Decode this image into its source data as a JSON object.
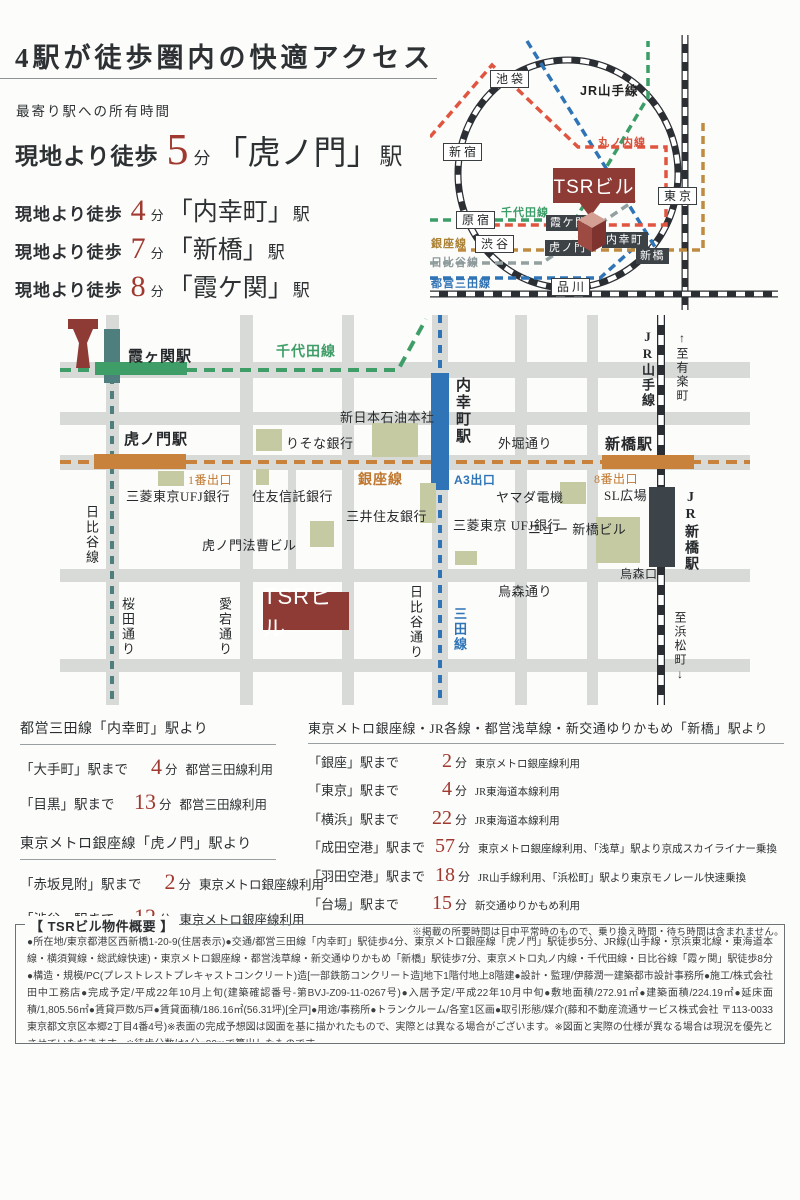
{
  "colors": {
    "accent_red": "#a03a31",
    "tsr_maroon": "#8e3b36",
    "chiyoda_green": "#3f9e68",
    "ginza_orange": "#c8823c",
    "hibiya_teal": "#4e7f7e",
    "hibiya_gray": "#93a0a0",
    "mita_blue": "#2e74b6",
    "marunouchi_red": "#e0553f",
    "building_olive": "#c6caa3",
    "road_gray": "#d8dad8"
  },
  "header": {
    "title": "4駅が徒歩圏内の快適アクセス",
    "subtitle": "最寄り駅への所有時間",
    "access": [
      {
        "prefix": "現地より徒歩",
        "num": "5",
        "unit": "分",
        "station": "「虎ノ門」",
        "suffix": "駅"
      },
      {
        "prefix": "現地より徒歩",
        "num": "4",
        "unit": "分",
        "station": "「内幸町」",
        "suffix": "駅"
      },
      {
        "prefix": "現地より徒歩",
        "num": "7",
        "unit": "分",
        "station": "「新橋」",
        "suffix": "駅"
      },
      {
        "prefix": "現地より徒歩",
        "num": "8",
        "unit": "分",
        "station": "「霞ケ関」",
        "suffix": "駅"
      }
    ]
  },
  "sch": {
    "jr": "JR山手線",
    "white": [
      "池袋",
      "新宿",
      "原宿",
      "渋谷",
      "品川",
      "東京"
    ],
    "dark": [
      "霞ケ関",
      "虎ノ門",
      "内幸町",
      "新橋"
    ],
    "lines": {
      "marunouchi": "丸ノ内線",
      "chiyoda": "千代田線",
      "ginza": "銀座線",
      "hibiya": "日比谷線",
      "mita": "都営三田線"
    },
    "tsr": "TSRビル"
  },
  "map": {
    "st": {
      "kasumigaseki": "霞ヶ関駅",
      "toranomon": "虎ノ門駅",
      "shimbashi": "新橋駅",
      "uchisaiwaicho": "内幸町駅",
      "jrshimbashi": "JR新橋駅"
    },
    "ln": {
      "chiyoda": "千代田線",
      "ginza": "銀座線",
      "hibiya": "日比谷線",
      "mita": "三田線",
      "yamanote": "JR山手線"
    },
    "ex": {
      "e1": "1番出口",
      "a3": "A3出口",
      "e8": "8番出口"
    },
    "rd": {
      "sotobori": "外堀通り",
      "sakurada": "桜田通り",
      "atago": "愛宕通り",
      "hibiyadori": "日比谷通り",
      "karasumori": "烏森通り",
      "karasumoriguchi": "烏森口"
    },
    "bl": {
      "oil": "新日本石油本社",
      "risona": "りそな銀行",
      "ufj": "三菱東京UFJ銀行",
      "sumitomo": "住友信託銀行",
      "smbc": "三井住友銀行",
      "hosou": "虎ノ門法曹ビル",
      "yamada": "ヤマダ電機",
      "sl": "SL広場",
      "ufj2": "三菱東京\nUFJ銀行",
      "newshim": "ニュー\n新橋ビル"
    },
    "dir": {
      "yurakucho": "↑至有楽町",
      "hamamatsucho": "至浜松町↓"
    },
    "tsr": "TSRビル"
  },
  "tbl": {
    "l": [
      {
        "header": "都営三田線「内幸町」駅より",
        "rows": [
          {
            "dest": "「大手町」駅まで",
            "min": "4",
            "unit": "分",
            "via": "都営三田線利用"
          },
          {
            "dest": "「目黒」駅まで",
            "min": "13",
            "unit": "分",
            "via": "都営三田線利用"
          }
        ]
      },
      {
        "header": "東京メトロ銀座線「虎ノ門」駅より",
        "rows": [
          {
            "dest": "「赤坂見附」駅まで",
            "min": "2",
            "unit": "分",
            "via": "東京メトロ銀座線利用"
          },
          {
            "dest": "「渋谷」駅まで",
            "min": "12",
            "unit": "分",
            "via": "東京メトロ銀座線利用"
          }
        ]
      }
    ],
    "r": {
      "header": "東京メトロ銀座線・JR各線・都営浅草線・新交通ゆりかもめ「新橋」駅より",
      "rows": [
        {
          "dest": "「銀座」駅まで",
          "min": "2",
          "unit": "分",
          "via": "東京メトロ銀座線利用"
        },
        {
          "dest": "「東京」駅まで",
          "min": "4",
          "unit": "分",
          "via": "JR東海道本線利用"
        },
        {
          "dest": "「横浜」駅まで",
          "min": "22",
          "unit": "分",
          "via": "JR東海道本線利用"
        },
        {
          "dest": "「成田空港」駅まで",
          "min": "57",
          "unit": "分",
          "via": "東京メトロ銀座線利用、「浅草」駅より京成スカイライナー乗換"
        },
        {
          "dest": "「羽田空港」駅まで",
          "min": "18",
          "unit": "分",
          "via": "JR山手線利用、「浜松町」駅より東京モノレール快速乗換"
        },
        {
          "dest": "「台場」駅まで",
          "min": "15",
          "unit": "分",
          "via": "新交通ゆりかもめ利用"
        }
      ],
      "note": "※掲載の所要時間は日中平常時のもので、乗り換え時間・待ち時間は含まれません。"
    }
  },
  "prop": {
    "title": "【 TSRビル物件概要 】",
    "body": "●所在地/東京都港区西新橋1-20-9(住居表示)●交通/都営三田線「内幸町」駅徒歩4分、東京メトロ銀座線「虎ノ門」駅徒歩5分、JR線(山手線・京浜東北線・東海道本線・横須賀線・総武線快速)・東京メトロ銀座線・都営浅草線・新交通ゆりかもめ「新橋」駅徒歩7分、東京メトロ丸ノ内線・千代田線・日比谷線「霞ヶ関」駅徒歩8分●構造・規模/PC(プレストレストプレキャストコンクリート)造[一部鉄筋コンクリート造]地下1階付地上8階建●設計・監理/伊藤潤一建築都市設計事務所●施工/株式会社田中工務店●完成予定/平成22年10月上旬(建築確認番号-第BVJ-Z09-11-0267号)●入居予定/平成22年10月中旬●敷地面積/272.91㎡●建築面積/224.19㎡●延床面積/1,805.56㎡●賃貸戸数/5戸●賃貸面積/186.16㎡(56.31坪)[全戸]●用途/事務所●トランクルーム/各室1区画●取引形態/媒介(藤和不動産流通サービス株式会社 〒113-0033 東京都文京区本郷2丁目4番4号)※表面の完成予想図は図面を基に描かれたもので、実際とは異なる場合がございます。※図面と実際の仕様が異なる場合は現況を優先とさせていただきます。※徒歩分数は1分=80mで算出したものです。"
  }
}
